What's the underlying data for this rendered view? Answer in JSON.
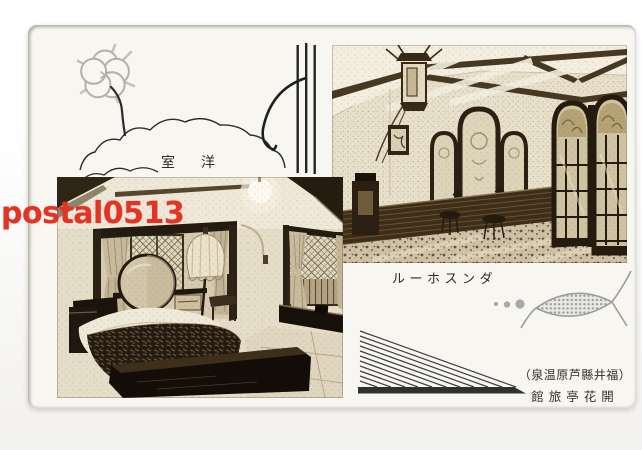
{
  "postcard": {
    "room_label": "室洋",
    "hall_label": "ルーホスンダ",
    "caption_line1": "（泉温原芦縣井福）",
    "caption_line2": "館旅亭花開",
    "photos": {
      "bedroom_alt": "Western-style hotel room: bed with dark patterned quilt, round mirror, frilled floor lamp, latticed bay windows with curtains",
      "hall_alt": "Dance hall: hanging lantern under beamed ceiling, triple arched window, glazed arched doors, dark wainscot and speckled floor"
    },
    "colors": {
      "card_bg": "#f8f6f1",
      "ink": "#2e2b27",
      "line_art": "#2a2a2a",
      "flower_gray": "#b4b0a6",
      "halftone_gray": "#9a9a9a",
      "sepia_dark": "#241b10",
      "sepia_light": "#e8e0cb"
    }
  },
  "watermark": {
    "text": "postal0513",
    "color": "#e23425"
  }
}
